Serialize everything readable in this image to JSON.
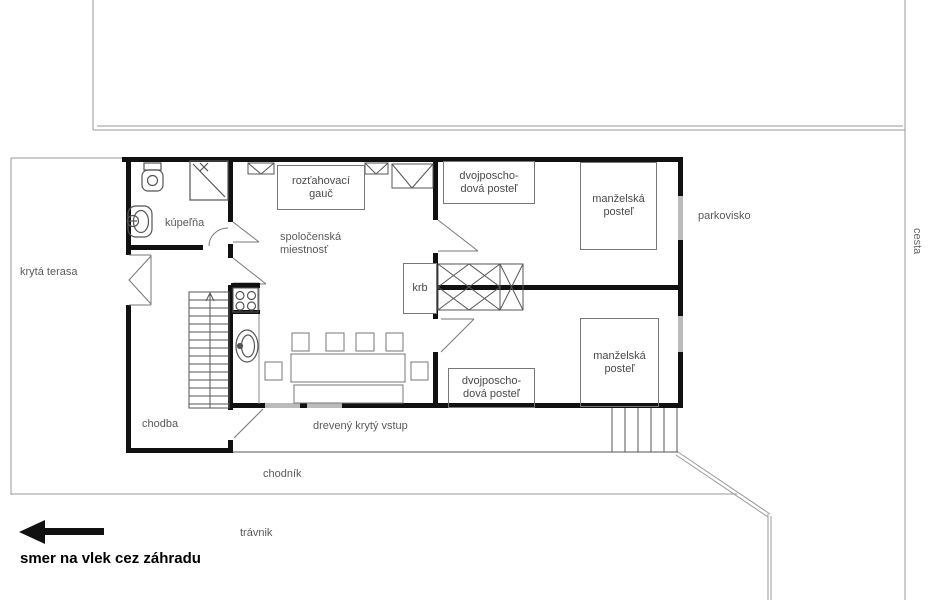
{
  "site": {
    "parking_label": "parkovisko",
    "road_label": "cesta",
    "sidewalk_label": "chodník",
    "lawn_label": "trávnik",
    "direction_label": "smer na vlek cez záhradu"
  },
  "rooms": {
    "terrace": "krytá terasa",
    "bathroom": "kúpeľňa",
    "living_room": {
      "line1": "spoločenská",
      "line2": "miestnosť"
    },
    "hallway": "chodba",
    "entrance": "drevený krytý vstup",
    "fireplace": "krb"
  },
  "furniture": {
    "sofa": {
      "line1": "rozťahovací",
      "line2": "gauč"
    },
    "bunk_bed": {
      "line1": "dvojposcho-",
      "line2": "dová posteľ"
    },
    "double_bed": {
      "line1": "manželská",
      "line2": "posteľ"
    }
  },
  "colors": {
    "wall": "#111111",
    "thin_outline": "#999999",
    "furniture_line": "#666666",
    "label_text": "#5a5a5a"
  }
}
